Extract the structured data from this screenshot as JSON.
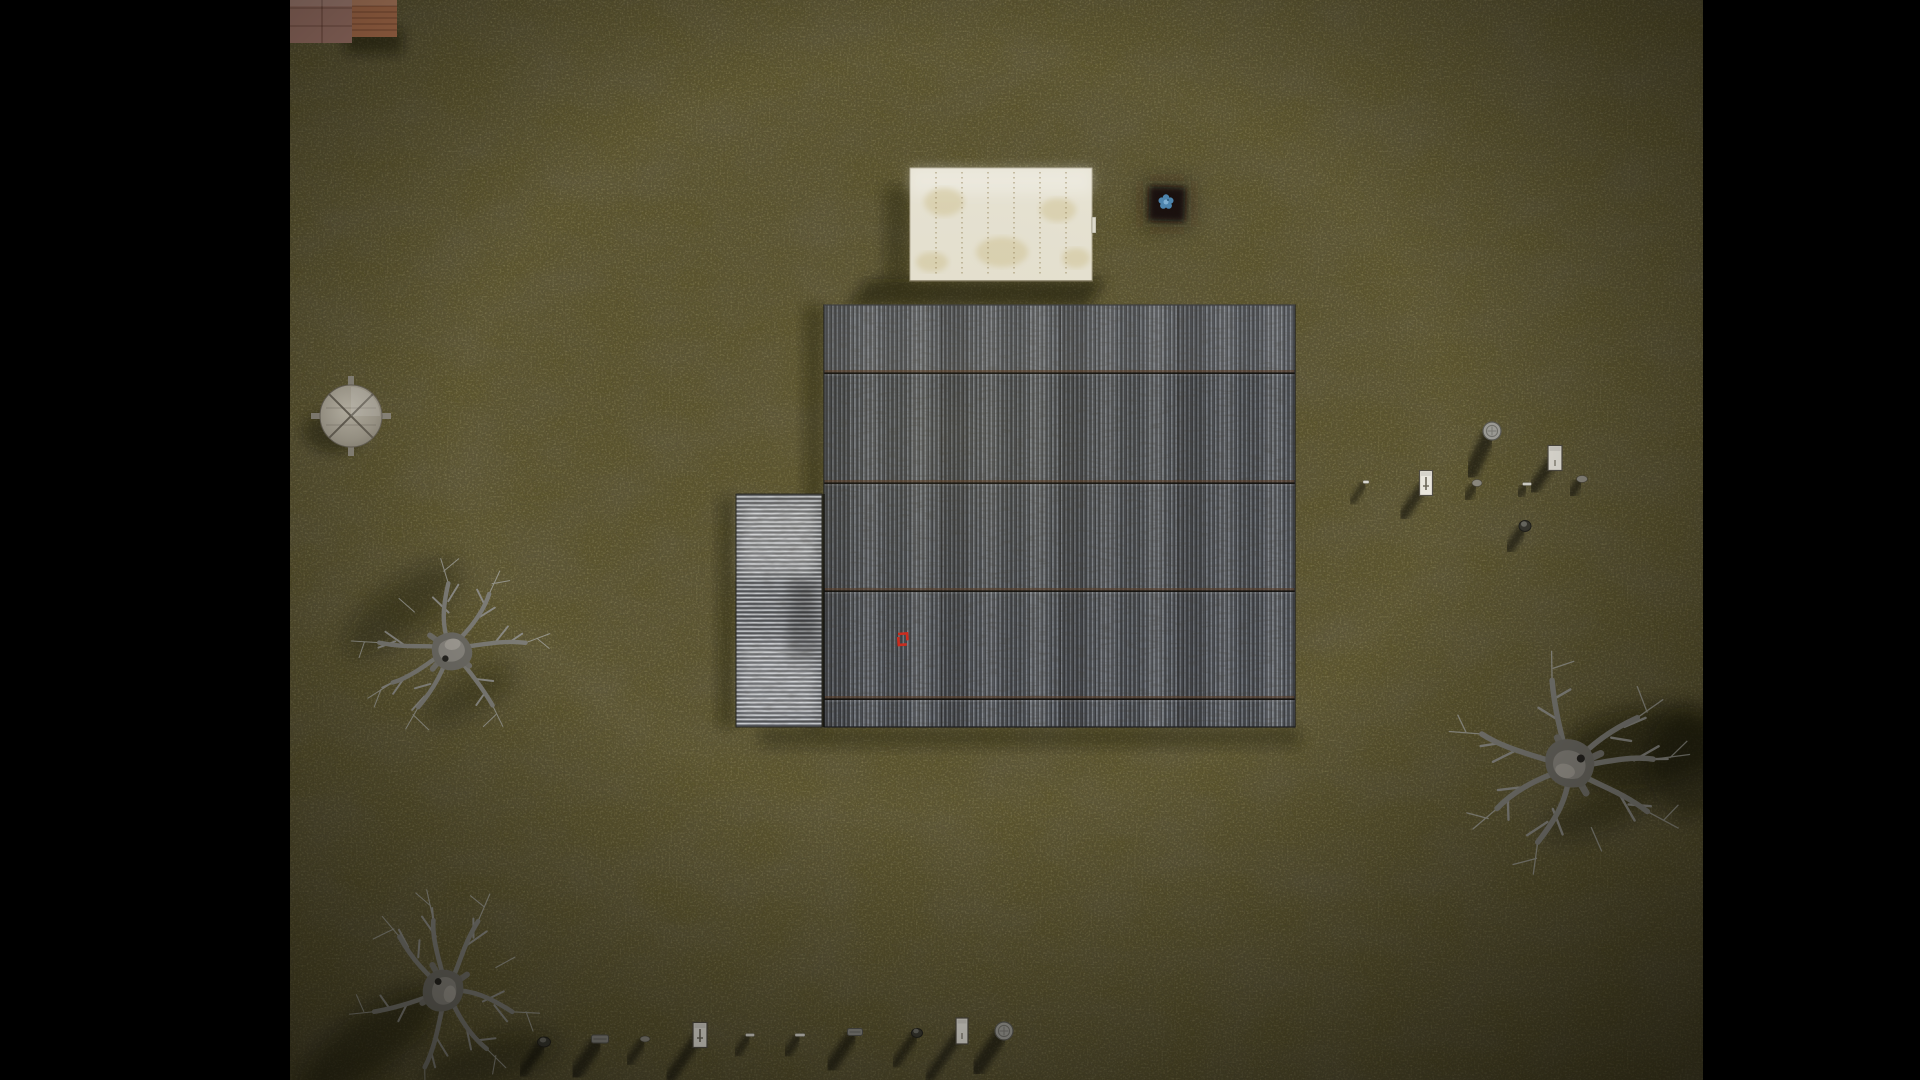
{
  "scene": {
    "viewport": {
      "width": 1920,
      "height": 1080
    },
    "letterbox": {
      "left_width": 290,
      "right_start": 1703,
      "color": "#000000"
    },
    "ground": {
      "base_color": "#5c552f",
      "dark_patch_color": "#3a351e",
      "light_patch_color": "#7a7040",
      "vignette_edge": "rgba(8,7,2,0.62)",
      "vignette_center_glow": "rgba(160,145,80,0.10)"
    },
    "buildings": {
      "warehouse_roof": {
        "x": 824,
        "y": 305,
        "width": 471,
        "height": 422,
        "seam_ys": [
          373,
          483,
          591,
          699
        ],
        "column_seam_xs": [
          942,
          1060,
          1178
        ],
        "corrugation_dark": "#393c41",
        "corrugation_light": "#7f848b",
        "rust_color": "rgba(92,62,38,0.55)"
      },
      "annex_roof": {
        "x": 736,
        "y": 494,
        "width": 86,
        "height": 233,
        "corrugation_dark": "#63666b",
        "corrugation_light": "#c9ccd0"
      },
      "white_building": {
        "x": 910,
        "y": 168,
        "width": 182,
        "height": 113,
        "color": "#ece8d8",
        "seam_color": "rgba(150,132,88,0.85)",
        "seam_offsets": [
          26,
          52,
          78,
          104,
          130,
          156
        ],
        "stains": [
          {
            "cx": 944,
            "cy": 202,
            "rx": 20,
            "ry": 14
          },
          {
            "cx": 1002,
            "cy": 252,
            "rx": 26,
            "ry": 15
          },
          {
            "cx": 1058,
            "cy": 210,
            "rx": 18,
            "ry": 12
          },
          {
            "cx": 932,
            "cy": 262,
            "rx": 16,
            "ry": 10
          },
          {
            "cx": 1076,
            "cy": 258,
            "rx": 14,
            "ry": 10
          }
        ],
        "sliver": {
          "x": 1092,
          "y": 217,
          "w": 4,
          "h": 16
        }
      },
      "brick_structure": {
        "left": {
          "x": 290,
          "y": 0,
          "w": 62,
          "h": 43,
          "color": "#a5796d"
        },
        "right": {
          "x": 352,
          "y": 0,
          "w": 45,
          "h": 37,
          "color": "#b0714e"
        },
        "seam_color": "rgba(62,30,18,0.4)"
      }
    },
    "water_tower": {
      "cx": 351,
      "cy": 416,
      "radius": 31,
      "color_center": "#c6c0b1",
      "color_edge": "#8f897b",
      "cross_color": "#6a6458"
    },
    "blue_item": {
      "square_x": 1149,
      "square_y": 187,
      "square_w": 36,
      "square_h": 34,
      "square_color": "#14110b",
      "flower_cx": 1166,
      "flower_cy": 202,
      "petal_color": "#4e86b0",
      "center_color": "#7fb2d6"
    },
    "red_marker": {
      "x": 898,
      "y": 634,
      "w": 9,
      "h": 11,
      "color": "#d02b1e"
    },
    "trees": [
      {
        "cx": 450,
        "cy": 648,
        "rot": -10,
        "scale": 0.8
      },
      {
        "cx": 447,
        "cy": 990,
        "rot": 100,
        "scale": 0.85
      },
      {
        "cx": 1570,
        "cy": 768,
        "rot": 195,
        "scale": 1.0
      }
    ],
    "tree_shadows": [
      {
        "cx": 402,
        "cy": 608,
        "rx": 70,
        "ry": 26,
        "rot": -38,
        "op": 0.3
      },
      {
        "cx": 470,
        "cy": 695,
        "rx": 50,
        "ry": 18,
        "rot": -30,
        "op": 0.25
      },
      {
        "cx": 370,
        "cy": 1042,
        "rx": 85,
        "ry": 30,
        "rot": -36,
        "op": 0.42
      },
      {
        "cx": 492,
        "cy": 1060,
        "rx": 70,
        "ry": 24,
        "rot": -15,
        "op": 0.3
      },
      {
        "cx": 1642,
        "cy": 748,
        "rx": 82,
        "ry": 40,
        "rot": -8,
        "op": 0.45
      },
      {
        "cx": 1688,
        "cy": 762,
        "rx": 40,
        "ry": 56,
        "rot": 0,
        "op": 0.4
      },
      {
        "cx": 1600,
        "cy": 812,
        "rx": 60,
        "ry": 20,
        "rot": -20,
        "op": 0.3
      }
    ],
    "building_shadows": [
      {
        "type": "poly",
        "points": "868,279 1105,279 1088,307 846,307",
        "op": 0.5
      },
      {
        "type": "rect",
        "x": 884,
        "y": 186,
        "w": 26,
        "h": 96,
        "op": 0.3
      },
      {
        "type": "rect",
        "x": 804,
        "y": 306,
        "w": 20,
        "h": 421,
        "op": 0.32
      },
      {
        "type": "rect",
        "x": 760,
        "y": 727,
        "w": 540,
        "h": 20,
        "op": 0.28
      },
      {
        "type": "rect",
        "x": 718,
        "y": 497,
        "w": 18,
        "h": 230,
        "op": 0.3
      },
      {
        "type": "ellipse2",
        "cx": 333,
        "cy": 432,
        "rx": 30,
        "ry": 21,
        "op": 0.38
      },
      {
        "type": "rect",
        "x": 345,
        "y": 28,
        "w": 58,
        "h": 26,
        "op": 0.45
      }
    ],
    "items": {
      "bottom_row": [
        {
          "type": "debris",
          "cx": 544,
          "cy": 1042,
          "w": 13,
          "h": 10,
          "shadow_len": 40
        },
        {
          "type": "plank",
          "cx": 600,
          "cy": 1039,
          "w": 17,
          "h": 8,
          "shadow_len": 45
        },
        {
          "type": "stone",
          "cx": 645,
          "cy": 1039,
          "w": 10,
          "h": 6,
          "shadow_len": 30
        },
        {
          "type": "door",
          "cx": 700,
          "cy": 1035,
          "w": 14,
          "h": 25,
          "shadow_len": 55,
          "glyph": true
        },
        {
          "type": "stick",
          "cx": 750,
          "cy": 1035,
          "w": 9,
          "h": 3,
          "shadow_len": 25
        },
        {
          "type": "stick",
          "cx": 800,
          "cy": 1035,
          "w": 10,
          "h": 3,
          "shadow_len": 25
        },
        {
          "type": "plank",
          "cx": 855,
          "cy": 1032,
          "w": 15,
          "h": 7,
          "shadow_len": 45
        },
        {
          "type": "debris",
          "cx": 917,
          "cy": 1033,
          "w": 11,
          "h": 9,
          "shadow_len": 40
        },
        {
          "type": "door",
          "cx": 962,
          "cy": 1031,
          "w": 12,
          "h": 26,
          "shadow_len": 60
        },
        {
          "type": "barrel",
          "cx": 1004,
          "cy": 1031,
          "r": 9,
          "shadow_len": 50
        }
      ],
      "right_cluster": [
        {
          "type": "barrel",
          "cx": 1492,
          "cy": 431,
          "r": 9,
          "shadow_len": 48,
          "shadow_dir": [
            -0.45,
            0.88
          ]
        },
        {
          "type": "door",
          "cx": 1555,
          "cy": 458,
          "w": 14,
          "h": 25,
          "shadow_len": 40
        },
        {
          "type": "door",
          "cx": 1426,
          "cy": 483,
          "w": 13,
          "h": 25,
          "shadow_len": 42,
          "glyph": true
        },
        {
          "type": "stone",
          "cx": 1477,
          "cy": 483,
          "w": 10,
          "h": 7,
          "shadow_len": 20
        },
        {
          "type": "stick",
          "cx": 1527,
          "cy": 484,
          "w": 9,
          "h": 3,
          "shadow_len": 15
        },
        {
          "type": "stone",
          "cx": 1582,
          "cy": 479,
          "w": 11,
          "h": 7,
          "shadow_len": 20
        },
        {
          "type": "debris",
          "cx": 1525,
          "cy": 526,
          "w": 12,
          "h": 11,
          "shadow_len": 30
        },
        {
          "type": "stick",
          "cx": 1366,
          "cy": 482,
          "w": 6,
          "h": 3,
          "shadow_len": 26
        }
      ]
    }
  }
}
